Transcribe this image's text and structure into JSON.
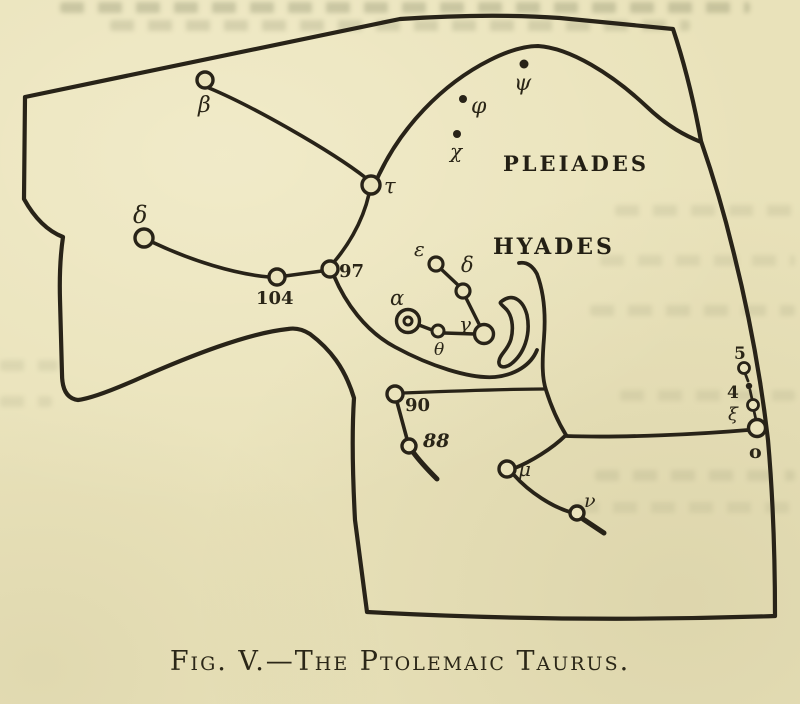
{
  "figure": {
    "caption": "Fig. V.—The Ptolemaic Taurus.",
    "regions": {
      "pleiades": "PLEIADES",
      "hyades": "HYADES"
    },
    "stars": {
      "beta": "β",
      "tau": "τ",
      "delta_left": "δ",
      "n104": "104",
      "n97": "97",
      "epsilon": "ε",
      "delta_hyades": "δ",
      "alpha": "α",
      "theta": "θ",
      "gamma": "γ",
      "psi": "ψ",
      "phi": "φ",
      "chi": "χ",
      "n5": "5",
      "n4": "4",
      "xi": "ξ",
      "omicron": "o",
      "n90": "90",
      "n88": "88",
      "mu": "μ",
      "nu": "ν"
    }
  },
  "colors": {
    "paper": "#e9e2ba",
    "ink": "#282318"
  }
}
